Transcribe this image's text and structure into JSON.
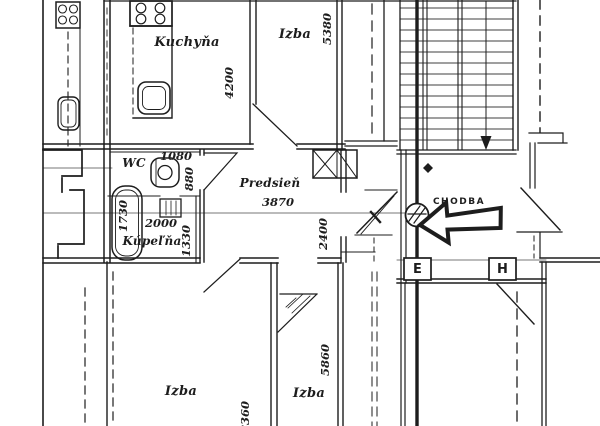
{
  "labels": {
    "kuchyna": "Kuchyňa",
    "izba_top": "Izba",
    "wc": "WC",
    "predsien": "Predsieň",
    "kupelna": "Kúpeľňa",
    "chodba": "CHODBA",
    "izba_bottom_left": "Izba",
    "izba_bottom_right": "Izba",
    "meter_e": "E",
    "meter_h": "H"
  },
  "dims": {
    "izba_top_width": "5380",
    "kuchyna_depth": "4200",
    "wc_width": "1080",
    "wc_depth": "880",
    "predsien_width": "3870",
    "predsien_depth": "2400",
    "bathtub_length": "1730",
    "kupelna_width": "2000",
    "kupelna_depth": "1330",
    "izba_bottom_right_depth": "5860",
    "izba_bottom_left_depth": "8360"
  },
  "colors": {
    "ink": "#1d1d1d",
    "paper": "#ffffff"
  }
}
